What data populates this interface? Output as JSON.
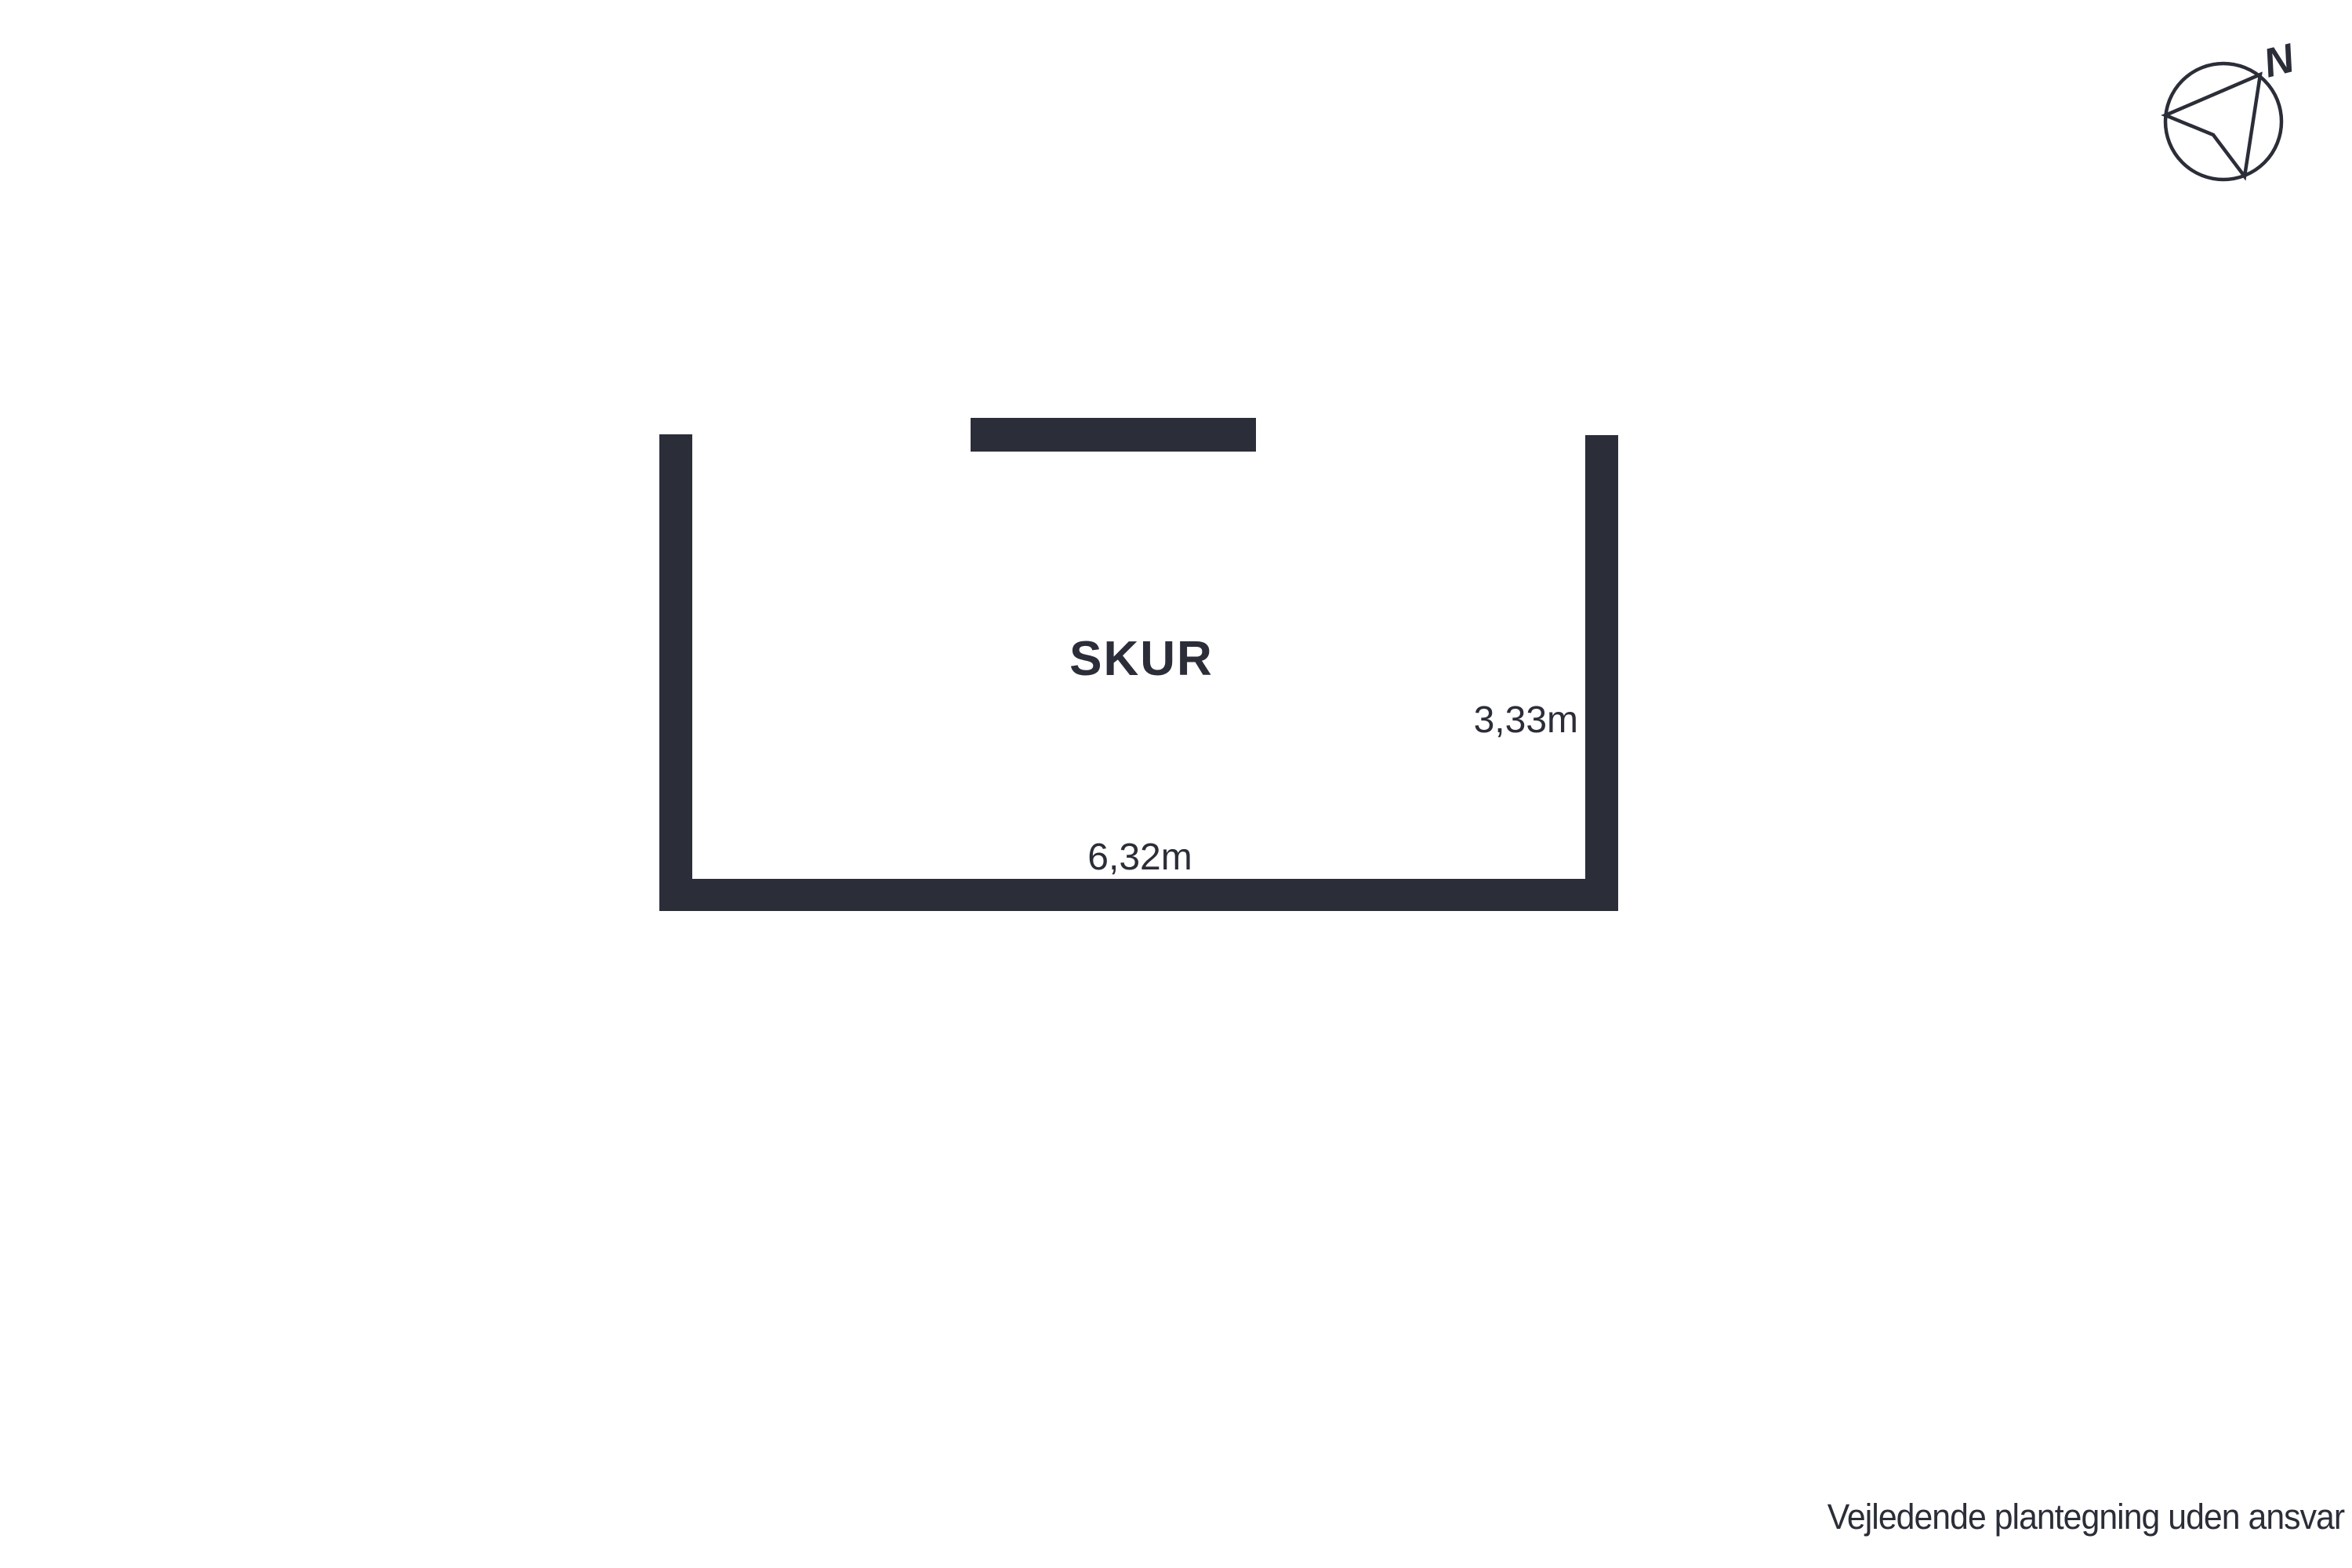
{
  "colors": {
    "ink": "#2b2e38",
    "background": "#ffffff"
  },
  "floorplan": {
    "room_label": "SKUR",
    "width_label": "6,32m",
    "height_label": "3,33m"
  },
  "compass": {
    "north_label": "N"
  },
  "footer": {
    "disclaimer": "Vejledende plantegning uden ansvar"
  }
}
